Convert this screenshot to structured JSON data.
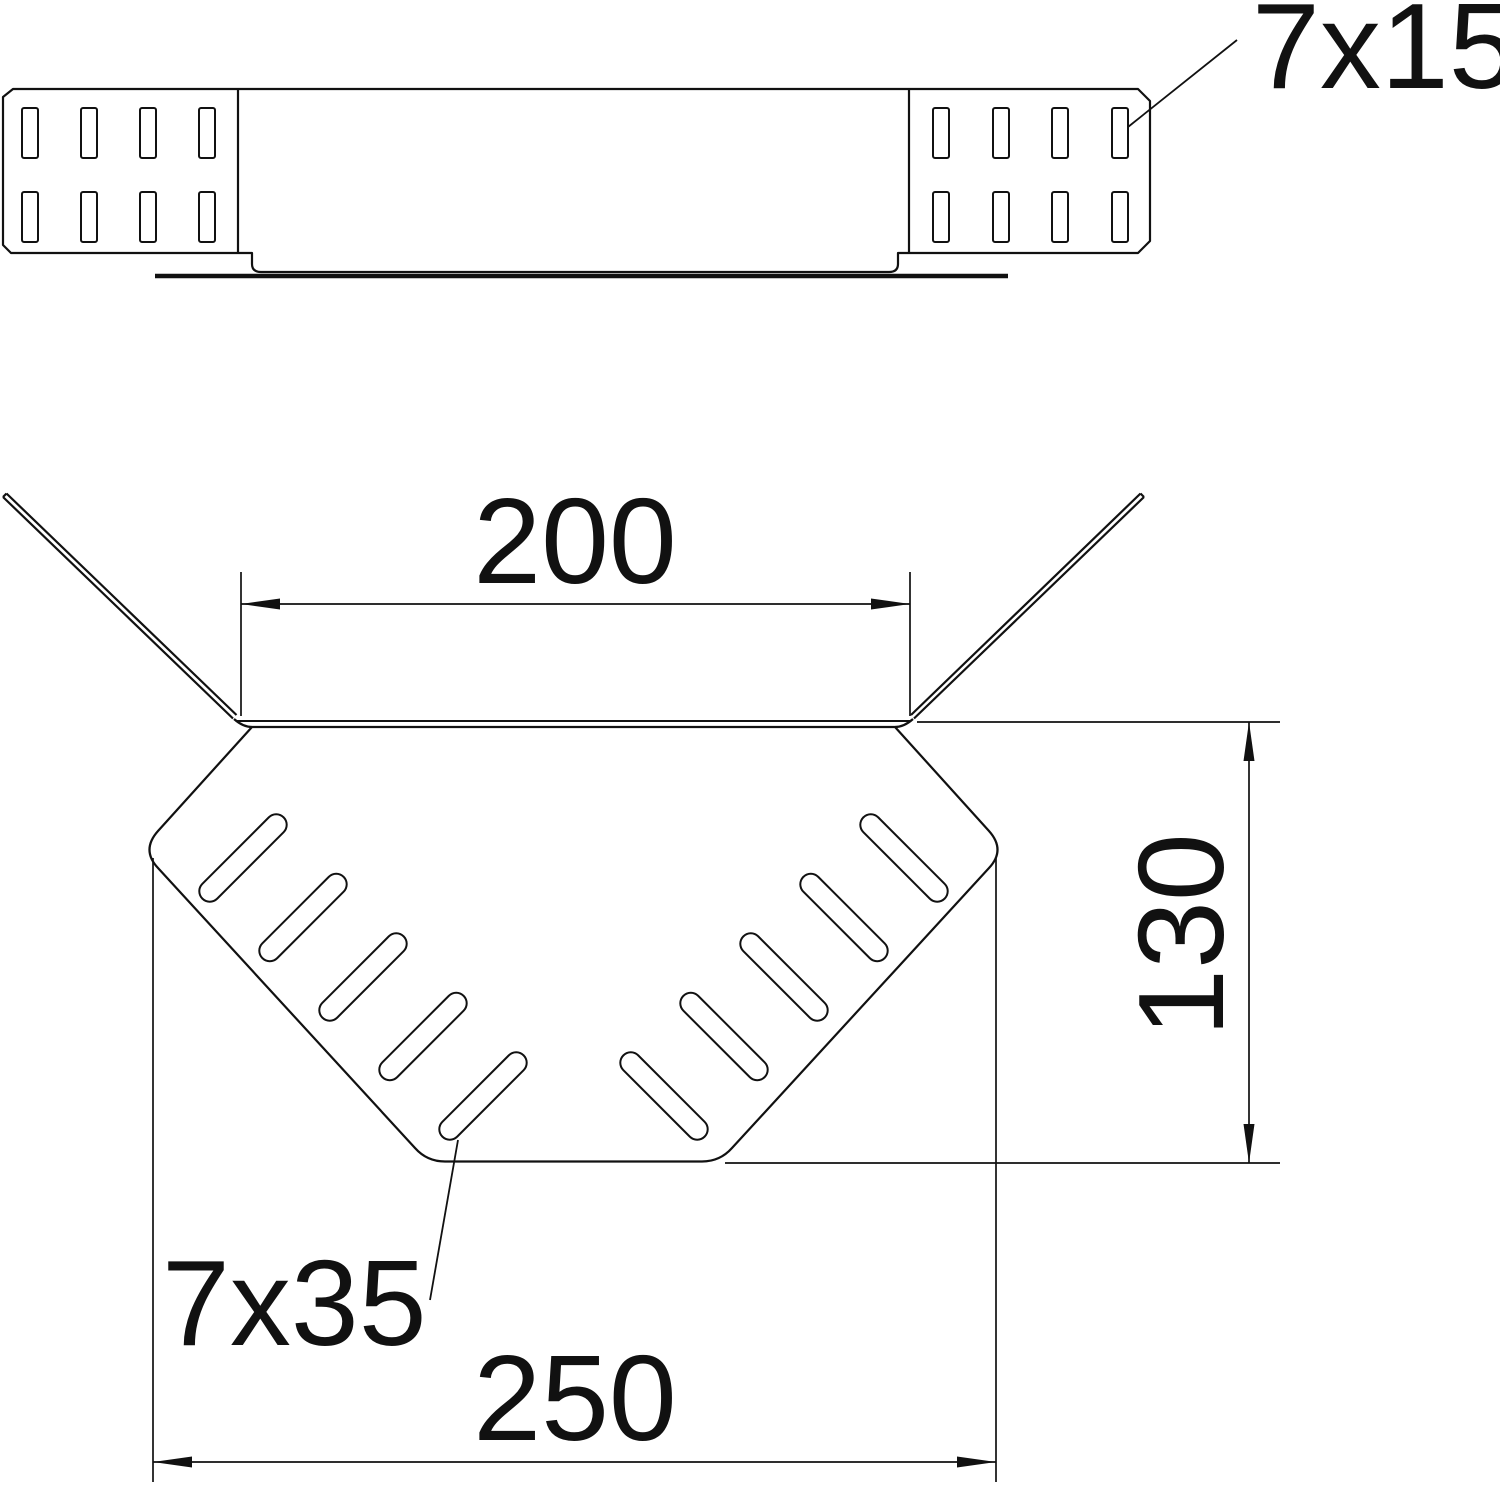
{
  "drawing": {
    "title": "cable-tray-corner-technical-drawing",
    "labels": {
      "slot_small": "7x15",
      "slot_large": "7x35"
    },
    "dimensions": {
      "inner_width": "200",
      "depth": "130",
      "outer_width": "250"
    },
    "colors": {
      "line": "#111111",
      "background": "#ffffff"
    }
  }
}
